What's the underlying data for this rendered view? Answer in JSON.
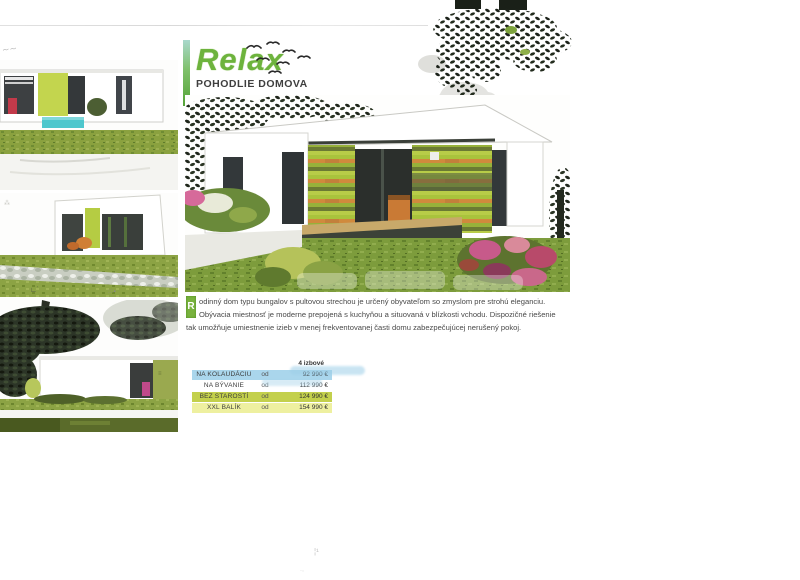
{
  "header": {
    "title": "Relax",
    "subtitle": "POHODLIE DOMOVA"
  },
  "description": {
    "drop_cap": "R",
    "text": "odinný dom typu bungalov s pultovou strechou je určený obyvateľom so zmyslom pre strohú eleganciu. Obývacia miestnosť je moderne prepojená s kuchyňou a situovaná v blízkosti vchodu. Dispozičné riešenie tak umožňuje umiestnenie izieb v menej frekventovanej časti domu zabezpečujúcej nerušený pokoj."
  },
  "price_table": {
    "column_header": "4 izbové",
    "rows": [
      {
        "label": "NA KOLAUDÁCIU",
        "prefix": "od",
        "price": "92 990 €",
        "row_color": "#aad6ec"
      },
      {
        "label": "NA BÝVANIE",
        "prefix": "od",
        "price": "112 990 €",
        "row_color": "#ffffff"
      },
      {
        "label": "BEZ STAROSTÍ",
        "prefix": "od",
        "price": "124 990 €",
        "row_color": "#c3d04c"
      },
      {
        "label": "XXL BALÍK",
        "prefix": "od",
        "price": "154 990 €",
        "row_color": "#eef0a0"
      }
    ]
  },
  "images": {
    "thumb_1": "house-render-front-with-pool",
    "thumb_2": "house-render-corner-view",
    "thumb_3": "house-render-rear-wall",
    "main": "house-render-main-bungalow-garden"
  },
  "colors": {
    "title_green": "#6db33d",
    "accent_lime": "#b5cc43",
    "cladding_orange": "#d08a3d",
    "pool_turquoise": "#4ec7cd",
    "table_blue": "#aad6ec",
    "table_olive": "#c3d04c",
    "table_yellow": "#eef0a0"
  }
}
